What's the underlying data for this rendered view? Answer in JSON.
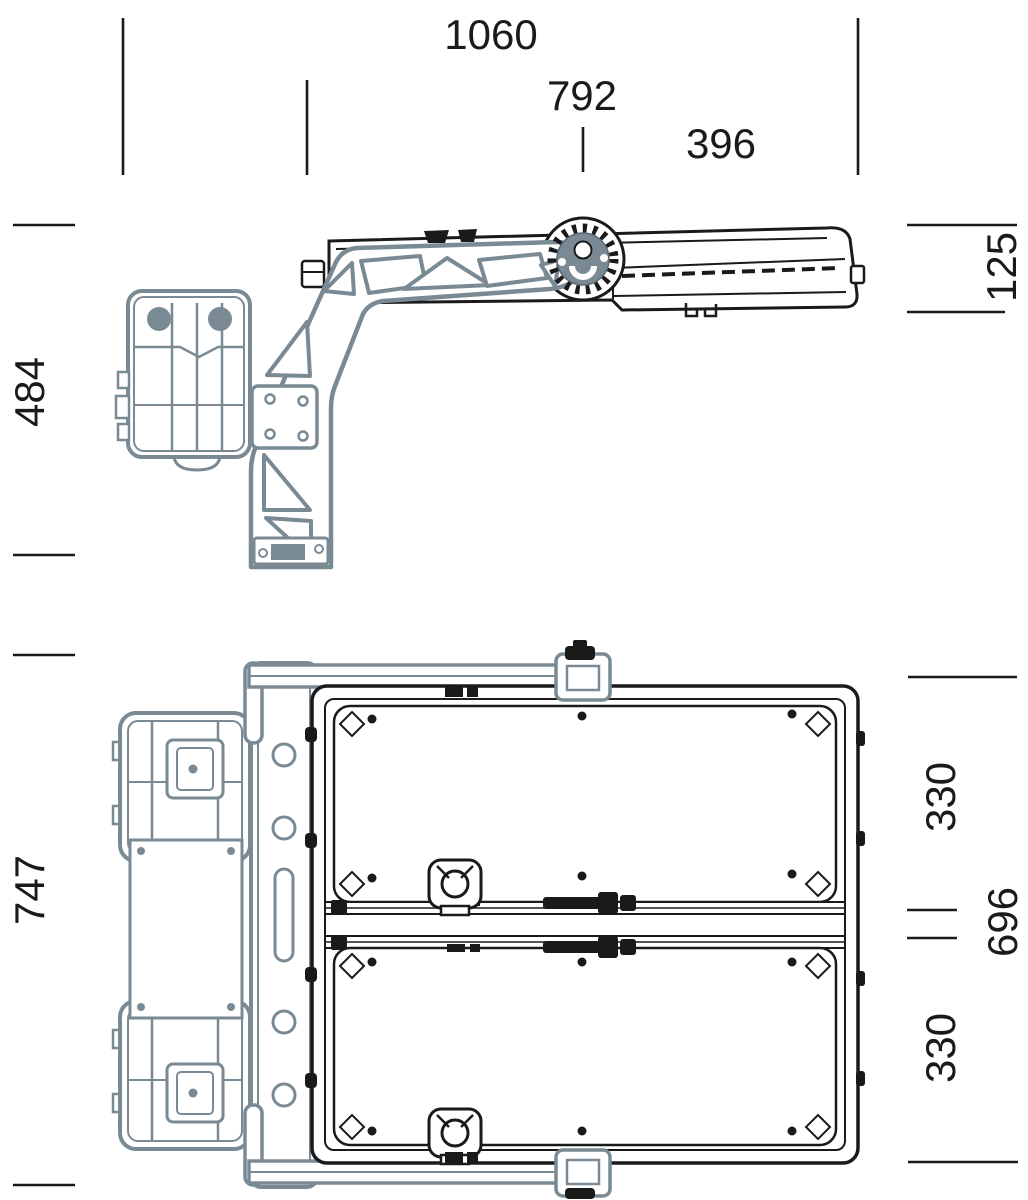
{
  "drawing": {
    "subject": "floodlight-with-pole-bracket-dimension-drawing",
    "background_color": "#ffffff",
    "ink_color": "#1a1a1a",
    "bracket_color": "#7a8a94",
    "dimensions": {
      "d1060": "1060",
      "d792": "792",
      "d396": "396",
      "d484": "484",
      "d125": "125",
      "d747": "747",
      "d330_top": "330",
      "d696": "696",
      "d330_bottom": "330"
    }
  }
}
